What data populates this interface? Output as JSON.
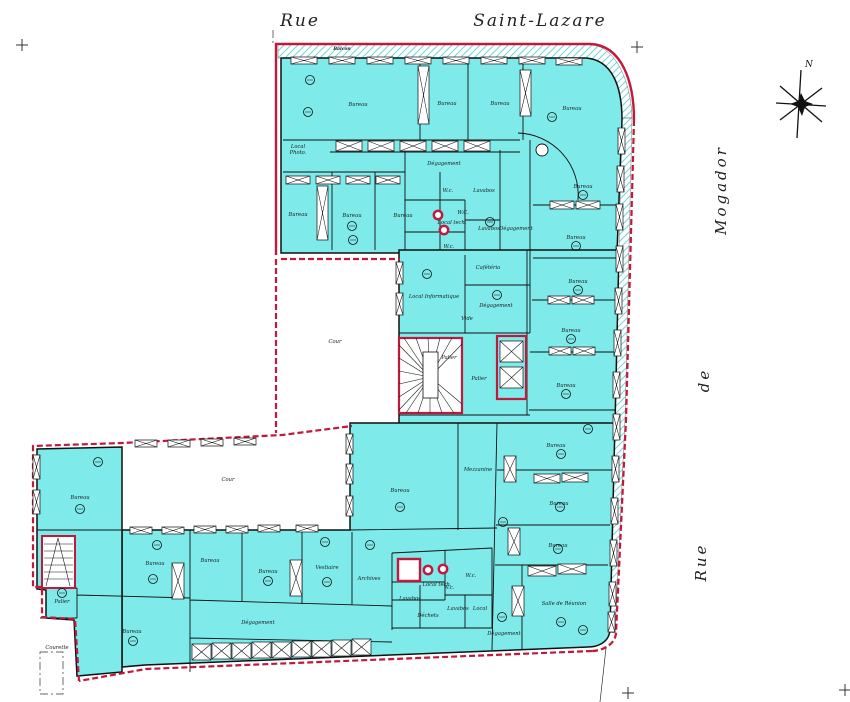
{
  "title": "Floor plan — Rue Saint-Lazare / Rue de Mogador",
  "streets": {
    "top_left": "Rue",
    "top_right": "Saint-Lazare",
    "right_upper": "Mogador",
    "right_middle": "de",
    "right_lower": "Rue"
  },
  "compass": {
    "north": "N"
  },
  "annotations": {
    "balcony": "Balcon"
  },
  "colors": {
    "room_fill": "#7eeaea",
    "boundary_red": "#c2183c",
    "wall_black": "#101010",
    "hatch_cyan": "#74d8d8"
  },
  "labels": [
    {
      "t": "Bureau",
      "x": 358,
      "y": 106
    },
    {
      "t": "Bureau",
      "x": 447,
      "y": 105
    },
    {
      "t": "Bureau",
      "x": 500,
      "y": 105
    },
    {
      "t": "Bureau",
      "x": 572,
      "y": 110
    },
    {
      "t": "Local",
      "x": 298,
      "y": 148,
      "fs": 4.4
    },
    {
      "t": "Photo.",
      "x": 298,
      "y": 154,
      "fs": 4.4
    },
    {
      "t": "Dégagement",
      "x": 444,
      "y": 165,
      "fs": 4.4
    },
    {
      "t": "Bureau",
      "x": 298,
      "y": 216
    },
    {
      "t": "Bureau",
      "x": 352,
      "y": 217
    },
    {
      "t": "Bureau",
      "x": 403,
      "y": 217
    },
    {
      "t": "W.c.",
      "x": 448,
      "y": 192,
      "fs": 4
    },
    {
      "t": "Lavabos",
      "x": 484,
      "y": 192,
      "fs": 4
    },
    {
      "t": "W.C.",
      "x": 463,
      "y": 214,
      "fs": 4
    },
    {
      "t": "Local tech.",
      "x": 452,
      "y": 224,
      "fs": 3.8
    },
    {
      "t": "Lavabos",
      "x": 489,
      "y": 230,
      "fs": 4
    },
    {
      "t": "W.c.",
      "x": 449,
      "y": 248,
      "fs": 4
    },
    {
      "t": "Dégagement",
      "x": 516,
      "y": 230,
      "fs": 4.4
    },
    {
      "t": "Bureau",
      "x": 583,
      "y": 188
    },
    {
      "t": "Bureau",
      "x": 576,
      "y": 239
    },
    {
      "t": "Bureau",
      "x": 578,
      "y": 283
    },
    {
      "t": "Bureau",
      "x": 571,
      "y": 332
    },
    {
      "t": "Bureau",
      "x": 566,
      "y": 387
    },
    {
      "t": "Cafétéria",
      "x": 488,
      "y": 269,
      "fs": 4.4
    },
    {
      "t": "Local Informatique",
      "x": 434,
      "y": 298,
      "fs": 4.4
    },
    {
      "t": "Dégagement",
      "x": 496,
      "y": 307,
      "fs": 4.4
    },
    {
      "t": "Vide",
      "x": 467,
      "y": 320,
      "fs": 3.8
    },
    {
      "t": "Palier",
      "x": 449,
      "y": 359,
      "fs": 4.4
    },
    {
      "t": "Palier",
      "x": 479,
      "y": 380,
      "fs": 4.4
    },
    {
      "t": "Cour",
      "x": 335,
      "y": 343,
      "fs": 6
    },
    {
      "t": "Cour",
      "x": 228,
      "y": 481,
      "fs": 5
    },
    {
      "t": "Bureau",
      "x": 80,
      "y": 499
    },
    {
      "t": "Bureau",
      "x": 400,
      "y": 492
    },
    {
      "t": "Mezzanine",
      "x": 478,
      "y": 471,
      "fs": 4.4
    },
    {
      "t": "Bureau",
      "x": 556,
      "y": 447
    },
    {
      "t": "Bureau",
      "x": 559,
      "y": 505
    },
    {
      "t": "Bureau",
      "x": 558,
      "y": 547
    },
    {
      "t": "Salle de Réunion",
      "x": 564,
      "y": 605,
      "fs": 4.4
    },
    {
      "t": "Dégagement",
      "x": 504,
      "y": 635,
      "fs": 4.2
    },
    {
      "t": "Bureau",
      "x": 155,
      "y": 565
    },
    {
      "t": "Bureau",
      "x": 210,
      "y": 562
    },
    {
      "t": "Bureau",
      "x": 268,
      "y": 573
    },
    {
      "t": "Vestiaire",
      "x": 327,
      "y": 569,
      "fs": 4.4
    },
    {
      "t": "Archives",
      "x": 369,
      "y": 580,
      "fs": 4.4
    },
    {
      "t": "Dégagement",
      "x": 258,
      "y": 624,
      "fs": 4.4
    },
    {
      "t": "Bureau",
      "x": 132,
      "y": 633
    },
    {
      "t": "Palier",
      "x": 62,
      "y": 603,
      "fs": 4.4
    },
    {
      "t": "Courette",
      "x": 57,
      "y": 649,
      "fs": 4
    },
    {
      "t": "Local tech.",
      "x": 437,
      "y": 586,
      "fs": 3.6
    },
    {
      "t": "W.c.",
      "x": 471,
      "y": 577,
      "fs": 4
    },
    {
      "t": "W.c.",
      "x": 449,
      "y": 589,
      "fs": 4
    },
    {
      "t": "Lavabos",
      "x": 410,
      "y": 600,
      "fs": 3.8
    },
    {
      "t": "Déchets",
      "x": 428,
      "y": 617,
      "fs": 3.8
    },
    {
      "t": "Lavabos",
      "x": 458,
      "y": 610,
      "fs": 3.8
    },
    {
      "t": "Local",
      "x": 480,
      "y": 610,
      "fs": 3.8
    }
  ],
  "symbols": {
    "windows": [
      [
        291,
        57,
        26,
        7
      ],
      [
        329,
        57,
        26,
        7
      ],
      [
        367,
        57,
        26,
        7
      ],
      [
        405,
        57,
        26,
        7
      ],
      [
        443,
        57,
        26,
        7
      ],
      [
        481,
        57,
        26,
        7
      ],
      [
        519,
        57,
        26,
        7
      ],
      [
        556,
        58,
        26,
        7
      ],
      [
        618,
        128,
        7,
        26
      ],
      [
        617,
        166,
        7,
        26
      ],
      [
        616,
        204,
        7,
        26
      ],
      [
        616,
        246,
        7,
        26
      ],
      [
        615,
        288,
        7,
        26
      ],
      [
        614,
        330,
        7,
        26
      ],
      [
        613,
        372,
        7,
        26
      ],
      [
        613,
        414,
        7,
        26
      ],
      [
        612,
        456,
        7,
        26
      ],
      [
        611,
        498,
        7,
        26
      ],
      [
        610,
        540,
        7,
        26
      ],
      [
        609,
        582,
        7,
        24
      ],
      [
        608,
        612,
        7,
        20
      ],
      [
        33,
        455,
        7,
        24
      ],
      [
        33,
        490,
        7,
        24
      ],
      [
        396,
        262,
        7,
        22
      ],
      [
        396,
        293,
        7,
        22
      ],
      [
        135,
        440,
        22,
        7
      ],
      [
        168,
        440,
        22,
        7
      ],
      [
        201,
        439,
        22,
        7
      ],
      [
        234,
        438,
        22,
        7
      ],
      [
        130,
        527,
        22,
        7
      ],
      [
        162,
        527,
        22,
        7
      ],
      [
        194,
        526,
        22,
        7
      ],
      [
        226,
        526,
        22,
        7
      ],
      [
        258,
        525,
        22,
        7
      ],
      [
        296,
        525,
        22,
        7
      ],
      [
        346,
        434,
        7,
        20
      ],
      [
        346,
        464,
        7,
        20
      ],
      [
        346,
        496,
        7,
        20
      ]
    ],
    "cupboards": [
      [
        336,
        141,
        26,
        10
      ],
      [
        368,
        141,
        26,
        10
      ],
      [
        400,
        141,
        26,
        10
      ],
      [
        432,
        141,
        26,
        10
      ],
      [
        464,
        141,
        26,
        10
      ],
      [
        286,
        176,
        24,
        8
      ],
      [
        316,
        176,
        24,
        8
      ],
      [
        346,
        176,
        24,
        8
      ],
      [
        376,
        176,
        24,
        8
      ],
      [
        550,
        201,
        24,
        8
      ],
      [
        576,
        201,
        24,
        8
      ],
      [
        548,
        296,
        22,
        8
      ],
      [
        572,
        296,
        22,
        8
      ],
      [
        549,
        347,
        22,
        8
      ],
      [
        573,
        347,
        22,
        8
      ],
      [
        534,
        474,
        26,
        9
      ],
      [
        562,
        473,
        26,
        9
      ],
      [
        528,
        566,
        28,
        10
      ],
      [
        558,
        564,
        28,
        10
      ]
    ],
    "piers": [
      [
        418,
        66,
        11,
        58
      ],
      [
        520,
        70,
        11,
        46
      ],
      [
        317,
        186,
        11,
        54
      ],
      [
        172,
        563,
        12,
        36
      ],
      [
        290,
        560,
        12,
        36
      ],
      [
        504,
        456,
        12,
        26
      ],
      [
        508,
        528,
        12,
        27
      ],
      [
        512,
        586,
        12,
        30
      ]
    ],
    "elevators": [
      [
        500,
        341,
        23,
        21
      ],
      [
        500,
        367,
        23,
        21
      ]
    ],
    "shelves": [
      [
        192,
        644,
        19,
        16
      ],
      [
        212,
        643,
        19,
        16
      ],
      [
        232,
        643,
        19,
        16
      ],
      [
        252,
        642,
        19,
        16
      ],
      [
        272,
        642,
        19,
        16
      ],
      [
        292,
        641,
        19,
        16
      ],
      [
        312,
        641,
        19,
        16
      ],
      [
        332,
        640,
        19,
        16
      ],
      [
        352,
        639,
        19,
        16
      ]
    ],
    "circles": [
      [
        310,
        80
      ],
      [
        308,
        112
      ],
      [
        352,
        226
      ],
      [
        353,
        240
      ],
      [
        552,
        117
      ],
      [
        583,
        195
      ],
      [
        576,
        246
      ],
      [
        578,
        290
      ],
      [
        571,
        339
      ],
      [
        566,
        394
      ],
      [
        427,
        274
      ],
      [
        497,
        295
      ],
      [
        490,
        222
      ],
      [
        98,
        462
      ],
      [
        80,
        509
      ],
      [
        62,
        593
      ],
      [
        133,
        641
      ],
      [
        157,
        545
      ],
      [
        153,
        579
      ],
      [
        325,
        542
      ],
      [
        327,
        582
      ],
      [
        370,
        545
      ],
      [
        561,
        454
      ],
      [
        560,
        507
      ],
      [
        558,
        549
      ],
      [
        561,
        622
      ],
      [
        583,
        630
      ],
      [
        503,
        522
      ],
      [
        502,
        617
      ],
      [
        588,
        429
      ],
      [
        400,
        507
      ],
      [
        268,
        581
      ]
    ],
    "red_circles": [
      [
        438,
        215
      ],
      [
        444,
        230
      ],
      [
        428,
        570
      ],
      [
        443,
        569
      ]
    ]
  }
}
